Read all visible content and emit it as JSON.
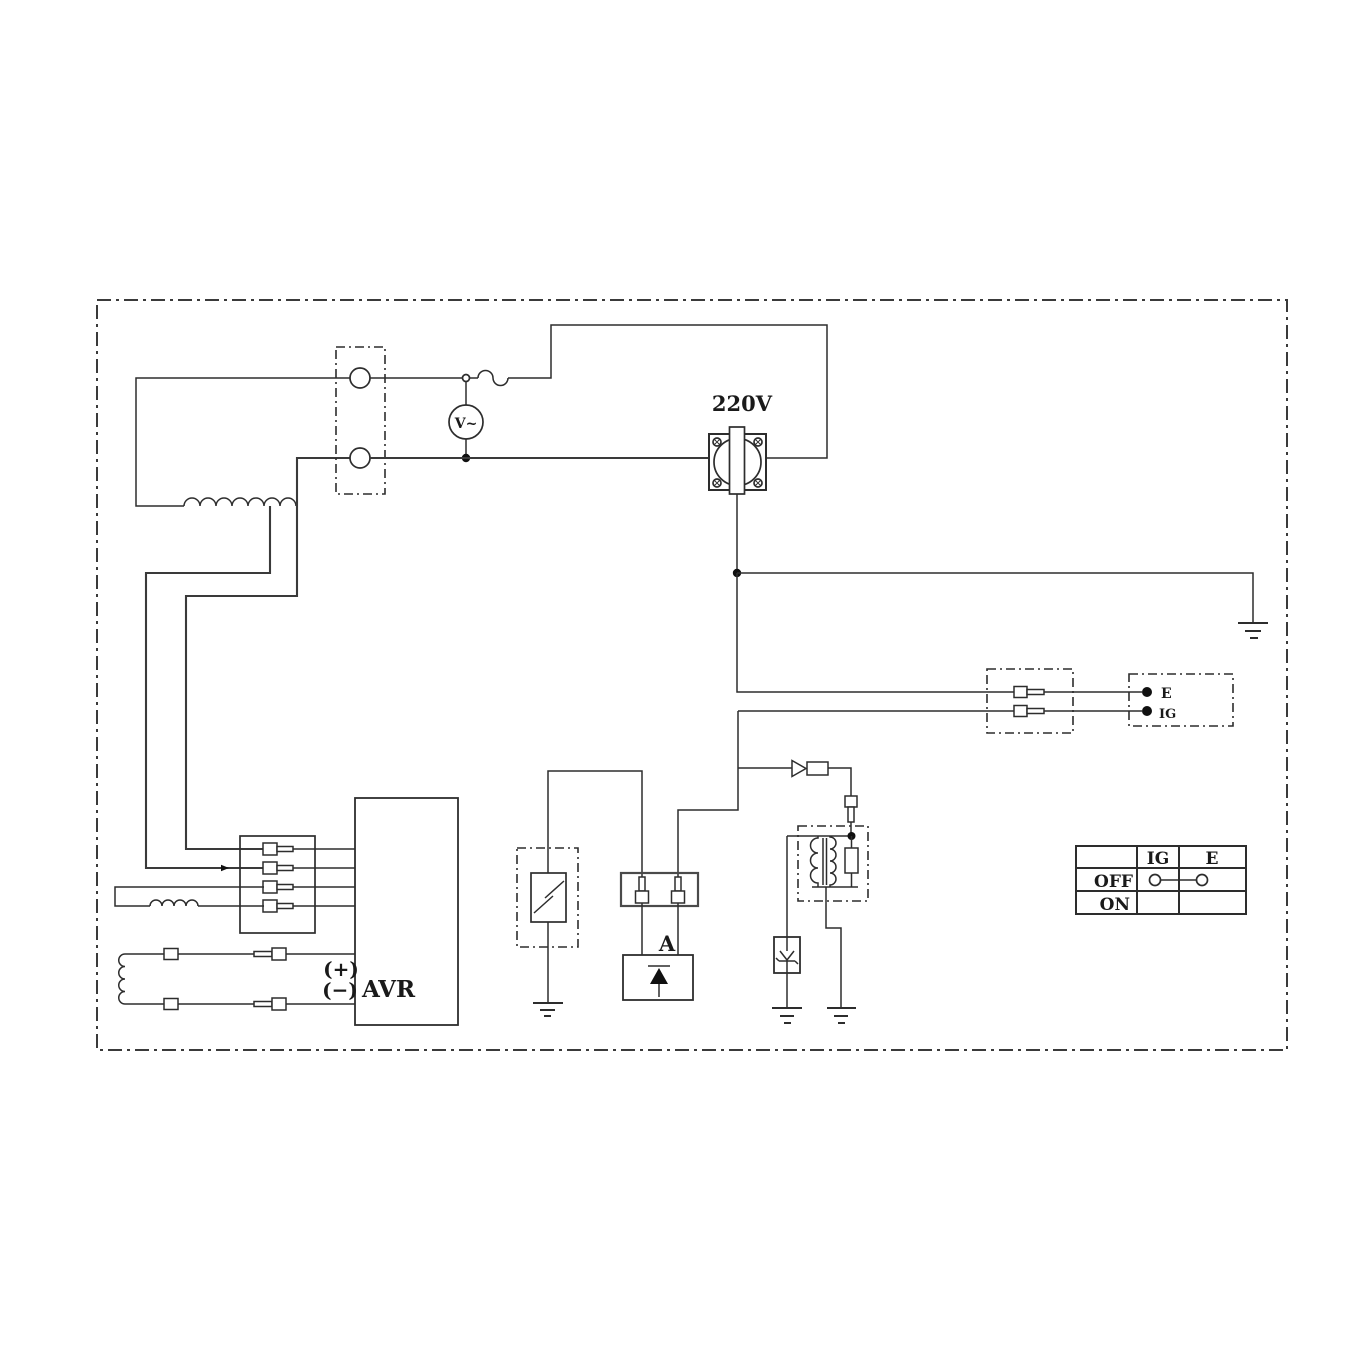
{
  "page": {
    "width": 1352,
    "height": 1352,
    "background": "#ffffff"
  },
  "colors": {
    "line": "#2d2d2d",
    "wire_heavy": "#3a3a3a",
    "fill_black": "#101010",
    "text": "#1a1a1a"
  },
  "labels": {
    "outlet_voltage": "220V",
    "voltmeter": "V~",
    "scr_unit": "A",
    "avr": "AVR",
    "field_plus": "(+)",
    "field_minus": "(−)"
  },
  "engine_terminals": {
    "e": "E",
    "ig": "IG"
  },
  "switch_table": {
    "col_ig": "IG",
    "col_e": "E",
    "row_off": "OFF",
    "row_on": "ON",
    "off_links": [
      "IG",
      "E"
    ]
  }
}
